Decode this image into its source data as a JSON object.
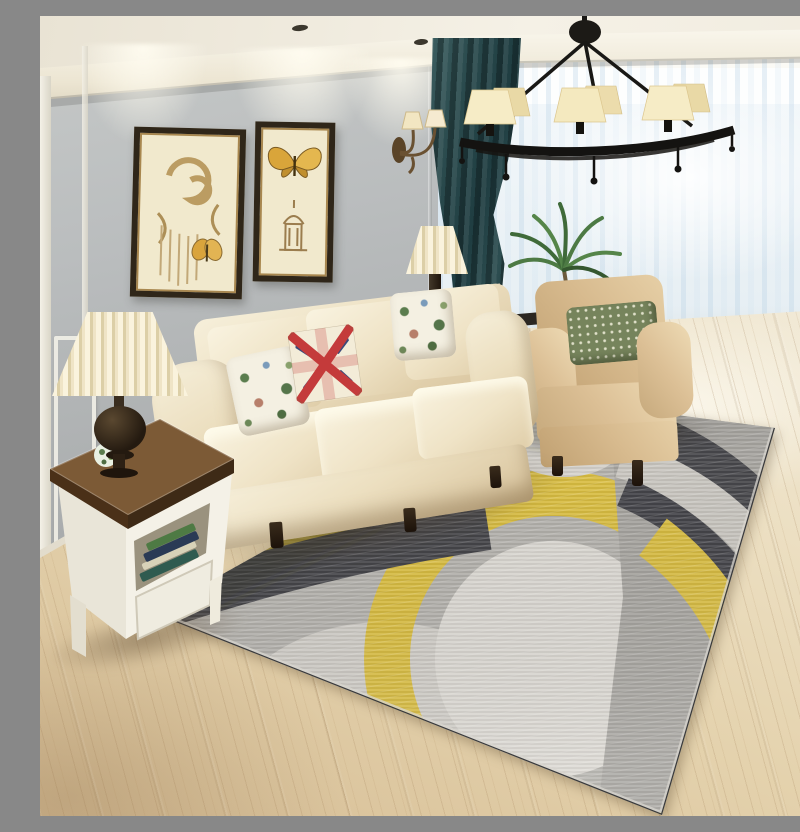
{
  "scene": {
    "description": "Living room product photograph: modern geometric area rug with overlapping yellow, charcoal, grey and ivory circle arcs laid on a light oak wood floor; cream fabric roll-arm sofa with two floral cushions and a Union Jack cushion; tan roll-arm armchair with a green polka-dot lumbar pillow; white side table with dark wood top holding a pleated-shade lamp and books; black wrought-iron chandelier with six cream shades; two framed sepia butterfly art prints on a grey panelled wall lit by ceiling spotlights; bronze twin wall sconce; dark teal drape beside floor-to-ceiling sheer white curtains; potted palm plant; white console table with driftwood decor and a small pleated lamp behind the sofa",
    "objects": [
      "chandelier",
      "wall-art-scroll-butterfly",
      "wall-art-butterfly-tower",
      "wall-sconce",
      "teal-curtain",
      "sheer-curtains",
      "palm-plant",
      "cream-sofa",
      "floral-cushion-left",
      "union-jack-cushion",
      "floral-cushion-right",
      "tan-armchair",
      "polka-dot-lumbar-pillow",
      "console-table",
      "console-lamp",
      "driftwood-decor",
      "side-table",
      "table-lamp",
      "books",
      "decor-ball",
      "geometric-rug",
      "wood-floor",
      "crown-molding",
      "spotlights"
    ]
  },
  "palette": {
    "wall_grey": "#b6b9ba",
    "crown_molding": "#fbf8f0",
    "ceiling": "#f1ece0",
    "curtain_teal": "#27474b",
    "sheer_white": "#f2f7fa",
    "sofa_cream": "#ecdfc0",
    "armchair_tan": "#d7ba8e",
    "pillow_olive": "#76845c",
    "union_jack_red": "#c43b3b",
    "union_jack_blue": "#3b4a7a",
    "rug_base_grey": "#b4b2ad",
    "rug_light": "#dbd8d2",
    "rug_charcoal": "#47474b",
    "rug_yellow": "#d9bd42",
    "floor_oak": "#e4d2ad",
    "table_wood": "#6e4f33",
    "table_white": "#f1ede2",
    "iron_black": "#1f1d1a",
    "shade_cream": "#f2e5b8",
    "frame_brown": "#2f2619"
  }
}
